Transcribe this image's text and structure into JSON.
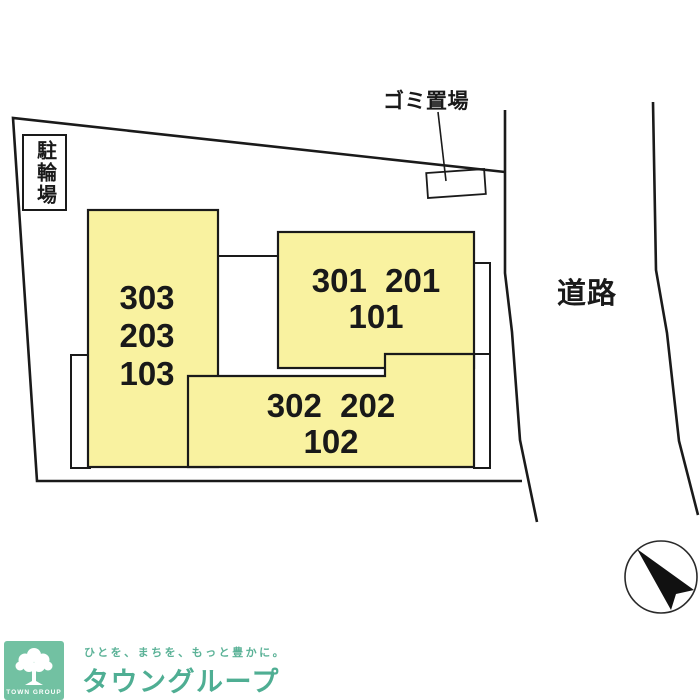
{
  "site_plan": {
    "bicycle_parking_label": "駐輪場",
    "garbage_label": "ゴミ置場",
    "road_label": "道路",
    "buildings": {
      "left": {
        "line1": "303",
        "line2": "203",
        "line3": "103"
      },
      "upper_right": {
        "line1": "301  201",
        "line2": "101"
      },
      "lower": {
        "line1": "302  202",
        "line2": "102"
      }
    },
    "colors": {
      "building_fill": "#f9f2a0",
      "line": "#1a1a1a"
    }
  },
  "footer_logo": {
    "tagline": "ひとを、まちを、もっと豊かに。",
    "brand_name": "タウングループ",
    "badge_text": "TOWN GROUP",
    "colors": {
      "badge_bg": "#72c1a2",
      "brand_text": "#4fae93"
    }
  }
}
